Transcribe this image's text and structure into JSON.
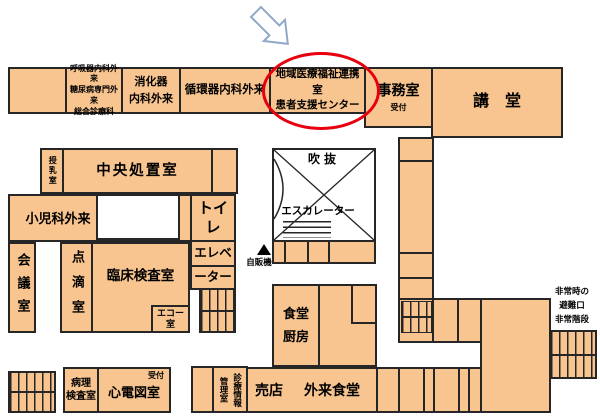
{
  "rooms": {
    "respiratory": {
      "line1": "呼吸器内科外来",
      "line2": "糖尿病専門外来",
      "line3": "総合診療科"
    },
    "digestive": {
      "line1": "消化器",
      "line2": "内科外来"
    },
    "cardiology": {
      "label": "循環器内科外来"
    },
    "regional_support": {
      "line1": "地域医療福祉連携室",
      "line2": "患者支援センター"
    },
    "admin_office": {
      "label": "事務室",
      "sub": "受付"
    },
    "auditorium": {
      "label": "講　堂"
    },
    "nursing_room": {
      "label": "授乳室"
    },
    "central_treatment": {
      "label": "中央処置室"
    },
    "pediatrics": {
      "label": "小児科外来"
    },
    "toilet": {
      "label": "トイレ"
    },
    "elevator": {
      "line1": "エレベ",
      "line2": "ーター"
    },
    "meeting_room": {
      "label": "会議室"
    },
    "iv_room": {
      "label": "点滴室"
    },
    "clinical_lab": {
      "label": "臨床検査室"
    },
    "echo_room": {
      "line1": "エコー",
      "line2": "室"
    },
    "atrium": {
      "label": "吹抜"
    },
    "escalator": {
      "label": "エスカレーター"
    },
    "vending": {
      "label": "自販機"
    },
    "kitchen": {
      "line1": "食堂",
      "line2": "厨房"
    },
    "shop": {
      "label": "売店"
    },
    "outpatient_dining": {
      "label": "外来食堂"
    },
    "pathology_lab": {
      "line1": "病理",
      "line2": "検査室"
    },
    "ecg_room": {
      "label": "心電図室",
      "sub": "受付"
    },
    "medical_records": {
      "col1": "診療情報",
      "col2": "管理室"
    },
    "emergency_exit": {
      "line1": "非常時の",
      "line2": "避難口",
      "line3": "非常階段"
    }
  },
  "colors": {
    "room_fill": "#F8C48F",
    "wall": "#262626",
    "highlight_circle": "#E8000F",
    "arrow_stroke": "#90A8C8"
  }
}
